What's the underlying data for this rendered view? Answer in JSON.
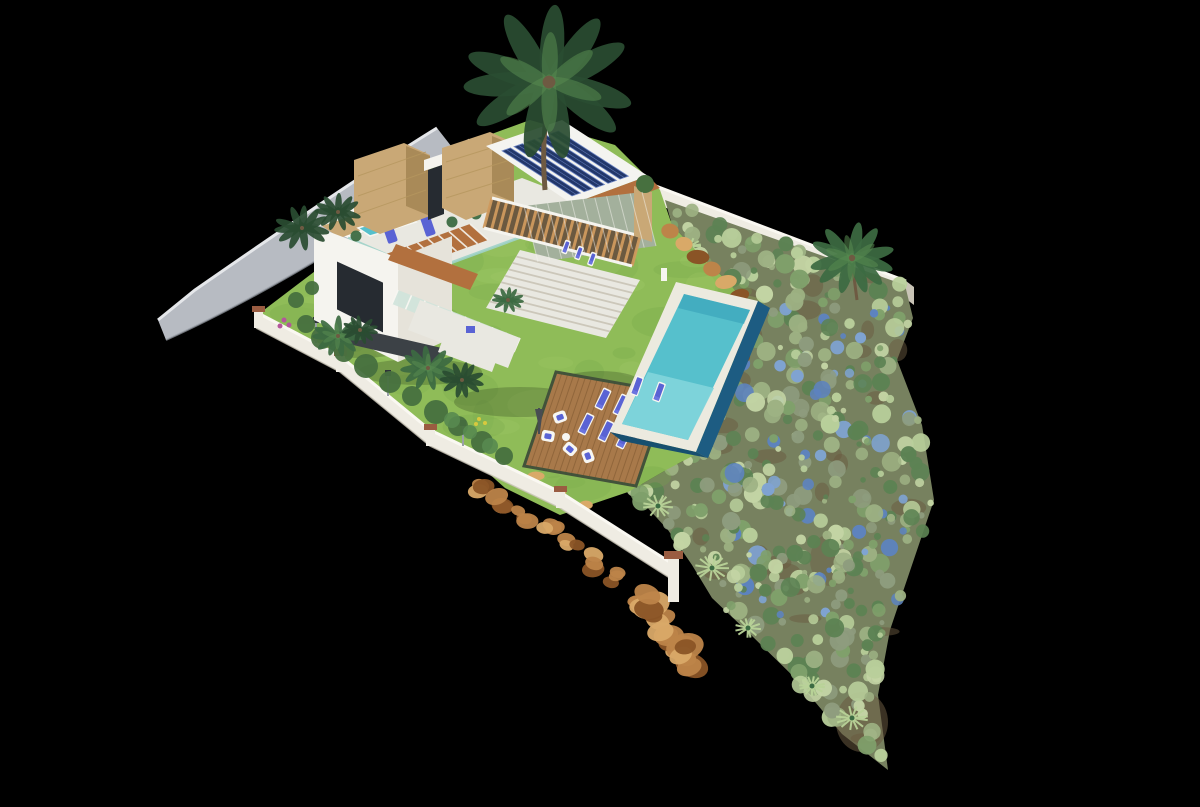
{
  "meta": {
    "description": "Aerial 3D architectural rendering of a modern two-storey villa on a wedge-shaped plot with lawn, infinity pool, wooden sun deck and drought-tolerant landscaped garden, isolated on a black background",
    "image_type": "3D render / architectural visualization",
    "background": "#000000"
  },
  "palette": {
    "road": "#b7bbc2",
    "road_dark": "#999ea7",
    "curb": "#e5e7ea",
    "wall": "#efece3",
    "wall_top": "#faf8f2",
    "wall_shadow": "#c9c4b6",
    "wall_cap": "#9a5c41",
    "lamp": "#9aa0a8",
    "lamp_cap": "#2e3338",
    "house_white": "#f5f4ef",
    "house_side": "#e6e3da",
    "house_floor": "#e9e8e1",
    "parapet": "#fbfaf6",
    "window_dark": "#262b31",
    "glass_teal": "#9ed2c9",
    "glass_band": "#cfe3da",
    "louver_face": "#a3b09c",
    "stone": "#c9a876",
    "stone_side": "#a98a58",
    "stone_line": "#b6975f",
    "terracotta": "#b2703e",
    "terracotta_slat": "#d09a62",
    "pergola_base": "#6b5940",
    "pergola_slat": "#cf9a5e",
    "solar_roof": "#f4f4f0",
    "solar_panel": "#22376a",
    "solar_line": "#6d85c4",
    "lawn": "#8fbc58",
    "lawn_hi": "#a5cc6c",
    "lawn_lo": "#74a64a",
    "ground_base": "#7d8a5e",
    "garden_ground": "#77815f",
    "garden_soil": "#695a40",
    "shrubs": [
      "#9db183",
      "#c3d4a4",
      "#7fa06b",
      "#5c8253",
      "#8e9c7e",
      "#b9cf9b"
    ],
    "flower_blue": "#7fa3d2",
    "flower_blue_dark": "#5d83bf",
    "flower_pink": "#b4569c",
    "flower_yellow": "#d8c93e",
    "pool_coping": "#eceadf",
    "pool_water": "#56c0cc",
    "pool_water_deep": "#359cb6",
    "pool_edge": "#1d5c82",
    "pool_edge_dark": "#174f6f",
    "pool_shelf": "#7fd4da",
    "deck": "#a8794a",
    "deck_line": "#7d5730",
    "deck_border": "#42523a",
    "lounger": "#5a63d4",
    "lounger_pad": "#6b74e0",
    "white_furniture": "#f7f6f1",
    "parasol": "#474c52",
    "driveway": "#3c4146",
    "rock": "#bd8449",
    "rock_light": "#d9a968",
    "rock_dark": "#8a5426",
    "palm": "#2a4c31",
    "palm_mid": "#3c6b42",
    "palm_light": "#588a50",
    "trunk": "#6e5a42",
    "bush": "#47703f",
    "agave": "#b9d398",
    "shadow": "#14200f"
  },
  "scene": {
    "objects": [
      "access-road",
      "perimeter-wall-left",
      "perimeter-wall-top-right",
      "rock-cliff",
      "villa",
      "stone-towers",
      "solar-panel-roof",
      "rooftop-terrace",
      "rooftop-plunge-pool",
      "pergola-walkway",
      "outdoor-staircase",
      "glass-balcony",
      "driveway-pad",
      "lawn",
      "infinity-pool",
      "pool-tanning-shelf",
      "wooden-sun-deck",
      "sun-loungers",
      "lounge-armchairs",
      "parasol",
      "landscaped-garden",
      "palm-trees"
    ],
    "furniture": {
      "deck_loungers": 6,
      "pool_shelf_loungers": 2,
      "terrace_loungers": 3,
      "rooftop_loungers": 2,
      "armchairs": 4,
      "side_tables": 1,
      "parasols": 1
    },
    "garden": {
      "shrub_count": 430,
      "soil_patch_count": 26,
      "agave_count": 6,
      "seed": 11
    },
    "palms": {
      "count": 9
    },
    "solar": {
      "panel_strips": 5
    }
  }
}
